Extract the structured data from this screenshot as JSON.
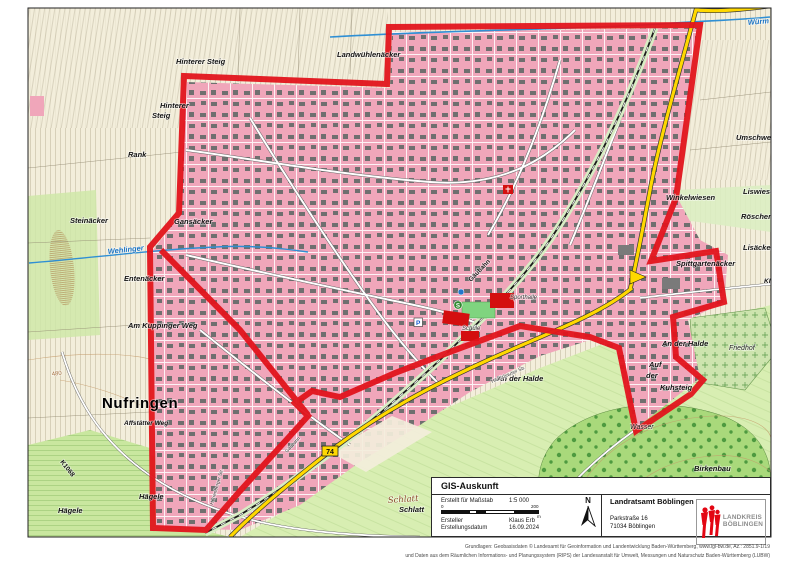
{
  "canvas": {
    "width": 800,
    "height": 566
  },
  "colors": {
    "boundary_red": "#e2141c",
    "urban_pink": "#f0a6ba",
    "building_gray": "#6f6f6f",
    "field_cream": "#f3eedb",
    "meadow_green": "#c9e79f",
    "forest_green": "#a9d97b",
    "road_yellow": "#ffd800",
    "water_blue": "#2f8fd4",
    "public_red": "#d40f0f",
    "contour_brown": "#c49a6a",
    "logo_red": "#e30613"
  },
  "map_labels": [
    {
      "t": "Hinterer Steig",
      "x": 176,
      "y": 64,
      "s": "field"
    },
    {
      "t": "Hinterer",
      "x": 160,
      "y": 108,
      "s": "field"
    },
    {
      "t": "Steig",
      "x": 152,
      "y": 118,
      "s": "field"
    },
    {
      "t": "Rank",
      "x": 128,
      "y": 157,
      "s": "field"
    },
    {
      "t": "Steinäcker",
      "x": 70,
      "y": 223,
      "s": "field"
    },
    {
      "t": "Gansäcker",
      "x": 174,
      "y": 224,
      "s": "field"
    },
    {
      "t": "Entenäcker",
      "x": 124,
      "y": 281,
      "s": "field"
    },
    {
      "t": "Am Kuppinger Weg",
      "x": 128,
      "y": 328,
      "s": "field"
    },
    {
      "t": "Landwühlenäcker",
      "x": 337,
      "y": 57,
      "s": "field"
    },
    {
      "t": "Umschweif",
      "x": 736,
      "y": 140,
      "s": "field"
    },
    {
      "t": "Liswiesen",
      "x": 743,
      "y": 194,
      "s": "field"
    },
    {
      "t": "Winkelwiesen",
      "x": 666,
      "y": 200,
      "s": "field"
    },
    {
      "t": "Röschenwiesen",
      "x": 741,
      "y": 219,
      "s": "field"
    },
    {
      "t": "Lisäcker",
      "x": 743,
      "y": 250,
      "s": "field"
    },
    {
      "t": "Spittgartenäcker",
      "x": 676,
      "y": 266,
      "s": "field"
    },
    {
      "t": "An der Halde",
      "x": 662,
      "y": 346,
      "s": "field"
    },
    {
      "t": "An der Halde",
      "x": 497,
      "y": 381,
      "s": "field"
    },
    {
      "t": "Auf",
      "x": 649,
      "y": 367,
      "s": "field"
    },
    {
      "t": "der",
      "x": 646,
      "y": 378,
      "s": "field"
    },
    {
      "t": "Kuhsteig",
      "x": 660,
      "y": 390,
      "s": "field"
    },
    {
      "t": "Hägele",
      "x": 139,
      "y": 499,
      "s": "field"
    },
    {
      "t": "Hägele",
      "x": 58,
      "y": 513,
      "s": "field"
    },
    {
      "t": "Affstätter Weg",
      "x": 124,
      "y": 425,
      "s": "field-sm"
    },
    {
      "t": "Wasser",
      "x": 630,
      "y": 429,
      "s": "poi"
    },
    {
      "t": "Birkenbau",
      "x": 694,
      "y": 471,
      "s": "field"
    },
    {
      "t": "Schlatt",
      "x": 388,
      "y": 503,
      "s": "serif-brown",
      "r": -4
    },
    {
      "t": "Schlatt",
      "x": 399,
      "y": 512,
      "s": "field"
    },
    {
      "t": "Friedhof",
      "x": 729,
      "y": 350,
      "s": "poi"
    },
    {
      "t": "Schule",
      "x": 462,
      "y": 330,
      "s": "poi-sm"
    },
    {
      "t": "Sporthalle",
      "x": 510,
      "y": 299,
      "s": "poi-sm"
    },
    {
      "t": "Nufringen",
      "x": 102,
      "y": 408,
      "s": "town"
    },
    {
      "t": "KlG",
      "x": 764,
      "y": 283,
      "s": "field-sm"
    },
    {
      "t": "Würm",
      "x": 748,
      "y": 25,
      "s": "water",
      "r": -5
    },
    {
      "t": "Wehlinger",
      "x": 108,
      "y": 254,
      "s": "water",
      "r": -6
    },
    {
      "t": "Gäubahn",
      "x": 471,
      "y": 282,
      "s": "rail",
      "r": -46
    },
    {
      "t": "Gäubahn",
      "x": 287,
      "y": 453,
      "s": "street",
      "r": -47
    },
    {
      "t": "K1068",
      "x": 60,
      "y": 462,
      "s": "road",
      "r": 52
    },
    {
      "t": "480",
      "x": 52,
      "y": 376,
      "s": "contour",
      "r": -8
    },
    {
      "t": "Herrenberger Str.",
      "x": 213,
      "y": 505,
      "s": "street",
      "r": -74
    },
    {
      "t": "Hildrizhauser Str.",
      "x": 492,
      "y": 383,
      "s": "street",
      "r": -23
    }
  ],
  "map_symbols": {
    "sbahn_label": "S",
    "parking_label": "P",
    "route_badge_label": "74"
  },
  "info_box": {
    "title": "GIS-Auskunft",
    "rows": [
      {
        "label": "Erstellt für Maßstab",
        "value": "1:5 000"
      },
      {
        "label": "Ersteller",
        "value": "Klaus Erb"
      },
      {
        "label": "Erstellungsdatum",
        "value": "16.09.2024"
      }
    ],
    "scale_bar": {
      "start": "0",
      "end": "200",
      "unit": "m"
    },
    "north_label": "N",
    "office": {
      "name": "Landratsamt Böblingen",
      "street": "Parkstraße 16",
      "city": "71034 Böblingen"
    },
    "logo": {
      "line1": "LANDKREIS",
      "line2": "BÖBLINGEN"
    }
  },
  "footer": {
    "line1": "Grundlagen: Geobasisdaten © Landesamt für Geoinformation und Landentwicklung Baden-Württemberg, www.lgl-bw.de, Az.: 2851.9-1/19",
    "line2": "und Daten aus dem Räumlichen Informations- und Planungssystem (RIPS) der Landesanstalt für Umwelt, Messungen und Naturschutz Baden-Württemberg (LUBW)"
  }
}
